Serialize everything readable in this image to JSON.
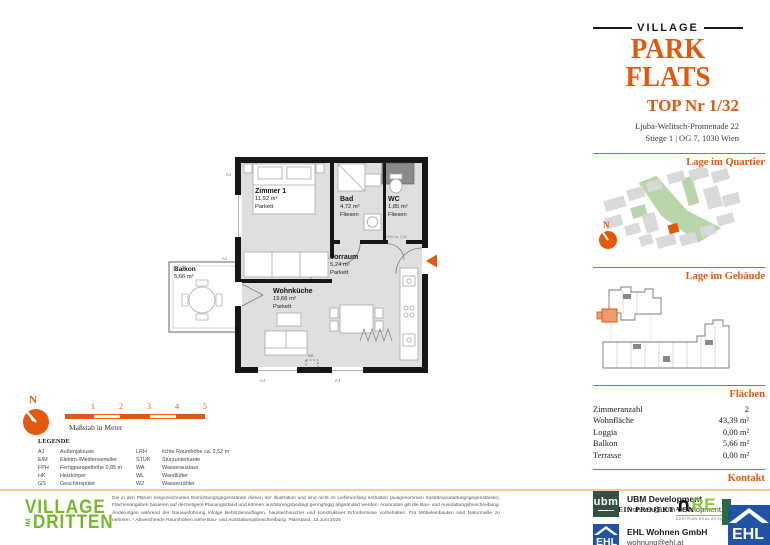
{
  "header": {
    "brand_top": "VILLAGE",
    "brand_main": "PARK FLATS",
    "unit_title": "TOP Nr 1/32",
    "address_line1": "Ljuba-Welitsch-Promenade 22",
    "address_line2": "Stiege 1 | OG 7, 1030 Wien"
  },
  "sections": {
    "quartier_title": "Lage im Quartier",
    "gebaeude_title": "Lage im Gebäude",
    "flaechen_title": "Flächen",
    "kontakt_title": "Kontakt"
  },
  "flaechen": {
    "rows": [
      {
        "label": "Zimmeranzahl",
        "value": "2"
      },
      {
        "label": "Wohnfläche",
        "value": "43,39 m²"
      },
      {
        "label": "Loggia",
        "value": "0,00 m²"
      },
      {
        "label": "Balkon",
        "value": "5,66 m²"
      },
      {
        "label": "Terrasse",
        "value": "0,00 m²"
      }
    ]
  },
  "kontakt": {
    "ubm_logo_text": "ubm",
    "ubm_name": "UBM Development",
    "ubm_email": "wohnen@ubm-development.com",
    "ehl_logo_text": "EHL",
    "ehl_name": "EHL Wohnen GmbH",
    "ehl_email": "wohnung@ehl.at",
    "website": "www.villageimdritten.at/parkflats"
  },
  "plan": {
    "compass_label": "N",
    "rooms": {
      "zimmer1": {
        "name": "Zimmer 1",
        "area": "11,92 m²",
        "floor": "Parkett"
      },
      "bad": {
        "name": "Bad",
        "area": "4,72 m²",
        "floor": "Fliesen"
      },
      "wc": {
        "name": "WC",
        "area": "1,85 m²",
        "floor": "Fliesen"
      },
      "vorraum": {
        "name": "Vorraum",
        "area": "5,24 m²",
        "floor": "Parkett"
      },
      "wohnkueche": {
        "name": "Wohnküche",
        "area": "19,66 m²",
        "floor": "Parkett"
      },
      "balkon": {
        "name": "Balkon",
        "area": "5,66 m²"
      }
    },
    "annotations": {
      "aj": "AJ",
      "wl": "WL",
      "lrh": "LRH ca. 2,52"
    }
  },
  "scalebar": {
    "ticks": [
      "1",
      "2",
      "3",
      "4",
      "5"
    ],
    "caption": "Maßstab in Meter"
  },
  "legend": {
    "title": "LEGENDE",
    "left": [
      {
        "abbr": "AJ",
        "text": "Außenjalousie"
      },
      {
        "abbr": "E/M",
        "text": "Elektro-/Medienverteiler"
      },
      {
        "abbr": "FPH",
        "text": "Fertigparapethöhe 0,85 m"
      },
      {
        "abbr": "HK",
        "text": "Heizkörper"
      },
      {
        "abbr": "GS",
        "text": "Geschirrspüler"
      }
    ],
    "right": [
      {
        "abbr": "LRH",
        "text": "lichte Raumhöhe ca. 2,52 m"
      },
      {
        "abbr": "STUK",
        "text": "Sturzunterkante"
      },
      {
        "abbr": "WA",
        "text": "Wasserauslass"
      },
      {
        "abbr": "WL",
        "text": "Wandlüfter"
      },
      {
        "abbr": "WZ",
        "text": "Wasserzähler"
      }
    ]
  },
  "footer": {
    "logo_line1": "VILLAGE",
    "logo_im": "IM",
    "logo_line2": "DRITTEN",
    "disclaimer": "Die in den Plänen eingezeichneten Einrichtungsgegenstände dienen der Illustration und sind nicht im Lieferumfang enthalten (ausgenommen Sanitärausstattungsgegenstände). Flächenangaben basieren auf derzeitigem Planungsstand und können ausführungsbedingt geringfügig abgeändert werden. Ansonsten gilt die Bau- und Ausstattungsbeschreibung. Änderungen während der Bauausführung infolge Behördenauflagen, haustechnischer und konstruktiver Erfordernisse vorbehalten. Für Möbeleinbauten sind Naturmaße zu nehmen. * Abweichende Raumhöhen siehe Bau- und Ausstattungsbeschreibung. Planstand: 12.Juni 2025",
    "project_label": "EIN PROJEKT VON",
    "are_cap": "∩",
    "are_re": "RE",
    "are_sub": "AUSTRIAN REAL ESTATE",
    "ehl_logo_text": "EHL"
  },
  "colors": {
    "accent_orange": "#E2590E",
    "village_green": "#76B82A",
    "ubm_green": "#33523F",
    "ehl_blue": "#2053A4",
    "are_green": "#8CC63F"
  }
}
